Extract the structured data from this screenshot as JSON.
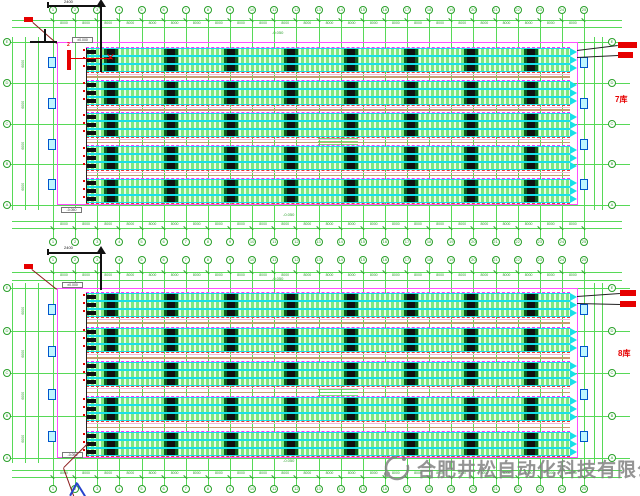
{
  "drawing": {
    "type": "warehouse-racking-floor-plan",
    "views": 2
  },
  "watermark": {
    "company": "合肥井松自动化科技有限公司"
  },
  "plans": [
    {
      "id": "upper-plan",
      "label": "7库",
      "section_label": "2",
      "bracket_dim": "2400",
      "bay_dim": "8000",
      "side_dim": "6000",
      "elevation_top": "±0.000",
      "elevation_bottom": "-0.050",
      "note": "-0.050",
      "col_labels": [
        "1",
        "2",
        "3",
        "4",
        "5",
        "6",
        "7",
        "8",
        "9",
        "10",
        "11",
        "12",
        "13",
        "14",
        "15",
        "16",
        "17",
        "18",
        "19",
        "20",
        "21",
        "22",
        "23",
        "24",
        "25"
      ],
      "row_labels": [
        "E",
        "D",
        "C",
        "B",
        "A"
      ]
    },
    {
      "id": "lower-plan",
      "label": "8库",
      "section_label": "2",
      "bracket_dim": "2400",
      "bay_dim": "8000",
      "side_dim": "6000",
      "elevation_top": "±0.000",
      "elevation_bottom": "-0.050",
      "note": "-0.050",
      "col_labels": [
        "1",
        "2",
        "3",
        "4",
        "5",
        "6",
        "7",
        "8",
        "9",
        "10",
        "11",
        "12",
        "13",
        "14",
        "15",
        "16",
        "17",
        "18",
        "19",
        "20",
        "21",
        "22",
        "23",
        "24",
        "25"
      ],
      "row_labels": [
        "E",
        "D",
        "C",
        "B",
        "A"
      ]
    }
  ],
  "colors": {
    "grid_green": "#57d957",
    "dim_green": "#2aa02a",
    "wall_magenta": "#ff4dff",
    "rack_cyan": "#19dfe8",
    "rack_fill_green": "#7fe87f",
    "rack_fill_light": "#e8fbe8",
    "cluster_black": "#101010",
    "cluster_green": "#0a5c20",
    "aisle_tan": "#c99a6e",
    "aisle_pink": "#f2b8d8",
    "dash_magenta": "#ff2bff",
    "dash_red": "#ee3333",
    "annotation_red": "#e60000",
    "leader_darkred": "#8b1a1a",
    "section_black": "#111111",
    "arrow_blue": "#2743cc",
    "door_cyan": "#bff6ff",
    "door_border": "#0055cc",
    "watermark_gray": "#7d7d7d"
  }
}
